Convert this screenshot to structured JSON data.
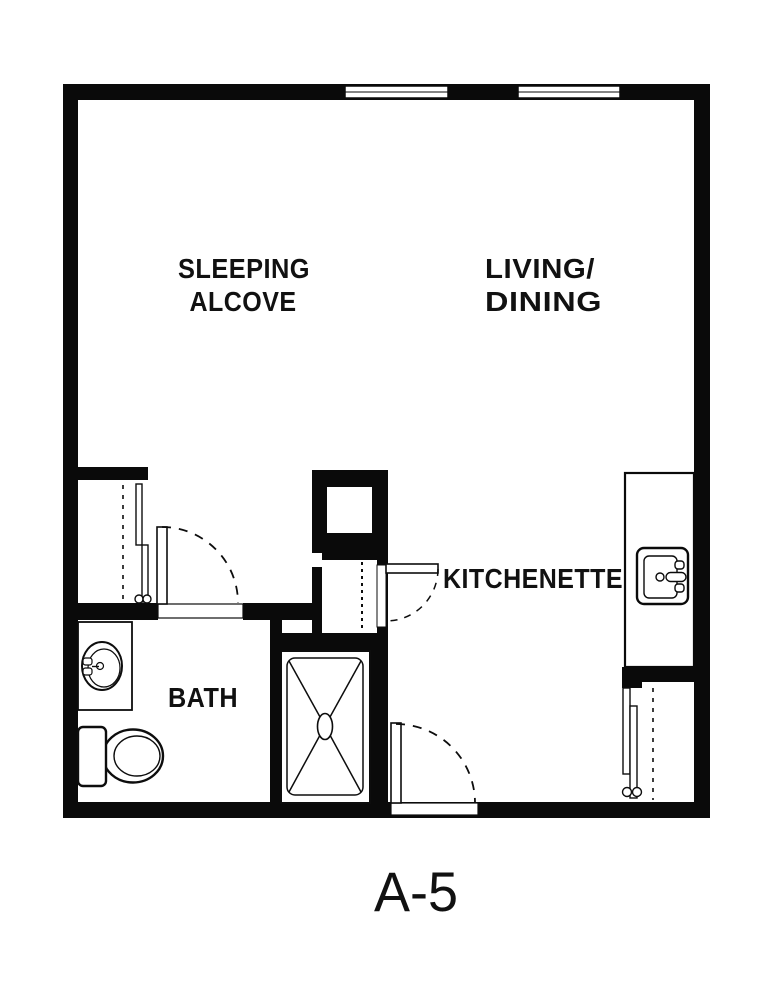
{
  "plan": {
    "unit_label": "A-5",
    "labels": {
      "sleeping_line1": "SLEEPING",
      "sleeping_line2": "ALCOVE",
      "living_line1": "LIVING/",
      "living_line2": "DINING",
      "kitchenette": "KITCHENETTE",
      "bath": "BATH"
    },
    "colors": {
      "wall": "#0a0a0a",
      "line": "#0d0d0d",
      "background": "#ffffff"
    },
    "windows": 2,
    "doors": [
      "bath-door",
      "utility-closet-door",
      "entry-door"
    ],
    "fixtures": [
      "bathroom-vanity-sink",
      "toilet",
      "shower",
      "kitchen-sink",
      "closet-rod-left",
      "closet-rod-right",
      "closet-rod-utility"
    ]
  }
}
